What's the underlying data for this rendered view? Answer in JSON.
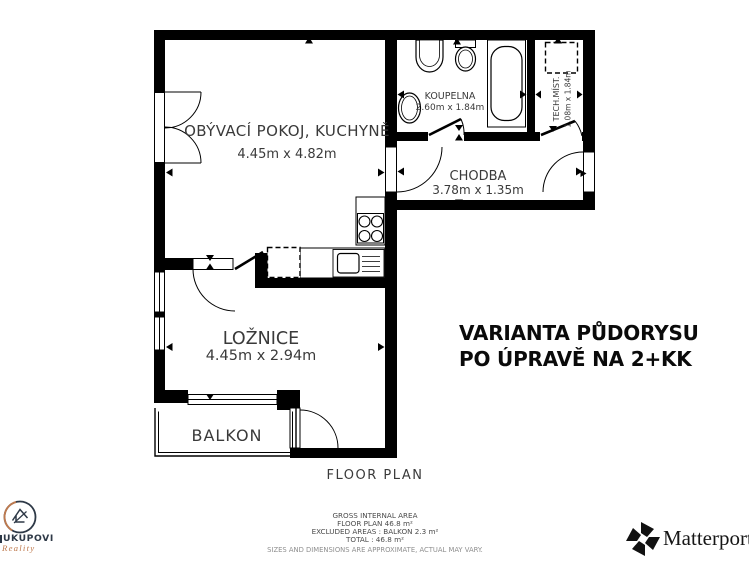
{
  "plan": {
    "rooms": {
      "living": {
        "name": "OBÝVACÍ POKOJ, KUCHYNĚ",
        "dims": "4.45m x 4.82m"
      },
      "bathroom": {
        "name": "KOUPELNA",
        "dims": "2.60m x 1.84m"
      },
      "tech": {
        "name": "TECH.MÍST.",
        "dims": "1.08m x 1.84m"
      },
      "hallway": {
        "name": "CHODBA",
        "dims": "3.78m x 1.35m"
      },
      "bedroom": {
        "name": "LOŽNICE",
        "dims": "4.45m x 2.94m"
      },
      "balcony": {
        "name": "BALKON"
      }
    },
    "caption": "FLOOR PLAN"
  },
  "variant_note": {
    "line1": "VARIANTA PŮDORYSU",
    "line2": "PO ÚPRAVĚ NA 2+KK"
  },
  "area_summary": {
    "heading": "GROSS INTERNAL AREA",
    "floor_plan": "FLOOR PLAN 46.8 m²",
    "excluded": "EXCLUDED AREAS :  BALKON 2.3 m²",
    "total": "TOTAL :  46.8 m²",
    "disclaimer": "SIZES AND DIMENSIONS ARE APPROXIMATE, ACTUAL MAY VARY."
  },
  "branding": {
    "agency": {
      "name": "UKUPOVI",
      "tagline": "Reality"
    },
    "matterport": "Matterport"
  },
  "colors": {
    "wall": "#000000",
    "navy": "#2e3947",
    "orange": "#bf7a4e"
  }
}
